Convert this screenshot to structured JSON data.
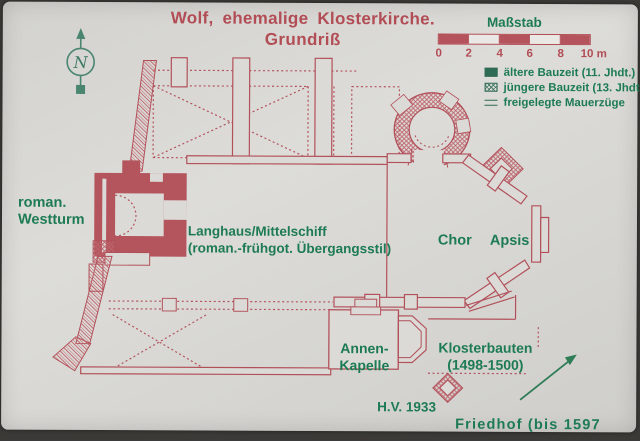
{
  "colors": {
    "plan_red": "#b24d56",
    "text_green": "#1d7b54",
    "legend_green": "#2e6b55",
    "sign_background": "#d8d7d3"
  },
  "title": [
    "Wolf, ehemalige Klosterkirche.",
    "Grundriß"
  ],
  "compass": {
    "letter": "N"
  },
  "scale": {
    "label": "Maßstab",
    "ticks": [
      "0",
      "2",
      "4",
      "6",
      "8",
      "10 m"
    ]
  },
  "legend": [
    {
      "symbol": "solid-square",
      "label": "ältere Bauzeit (11. Jhdt.)"
    },
    {
      "symbol": "hatched-square",
      "label": "jüngere Bauzeit (13. Jhdt.)"
    },
    {
      "symbol": "double-line",
      "label": "freigelegte Mauerzüge"
    }
  ],
  "plan_labels": {
    "westturm": [
      "roman.",
      "Westturm"
    ],
    "langhaus": [
      "Langhaus/Mittelschiff",
      "(roman.-frühgot. Übergangsstil)"
    ],
    "chor": "Chor",
    "apsis": "Apsis",
    "annenkapelle": [
      "Annen-",
      "Kapelle"
    ],
    "klosterbauten": [
      "Klosterbauten",
      "(1498-1500)"
    ],
    "survey_mark": "H.V. 1933",
    "friedhof": "Friedhof (bis 1597"
  }
}
